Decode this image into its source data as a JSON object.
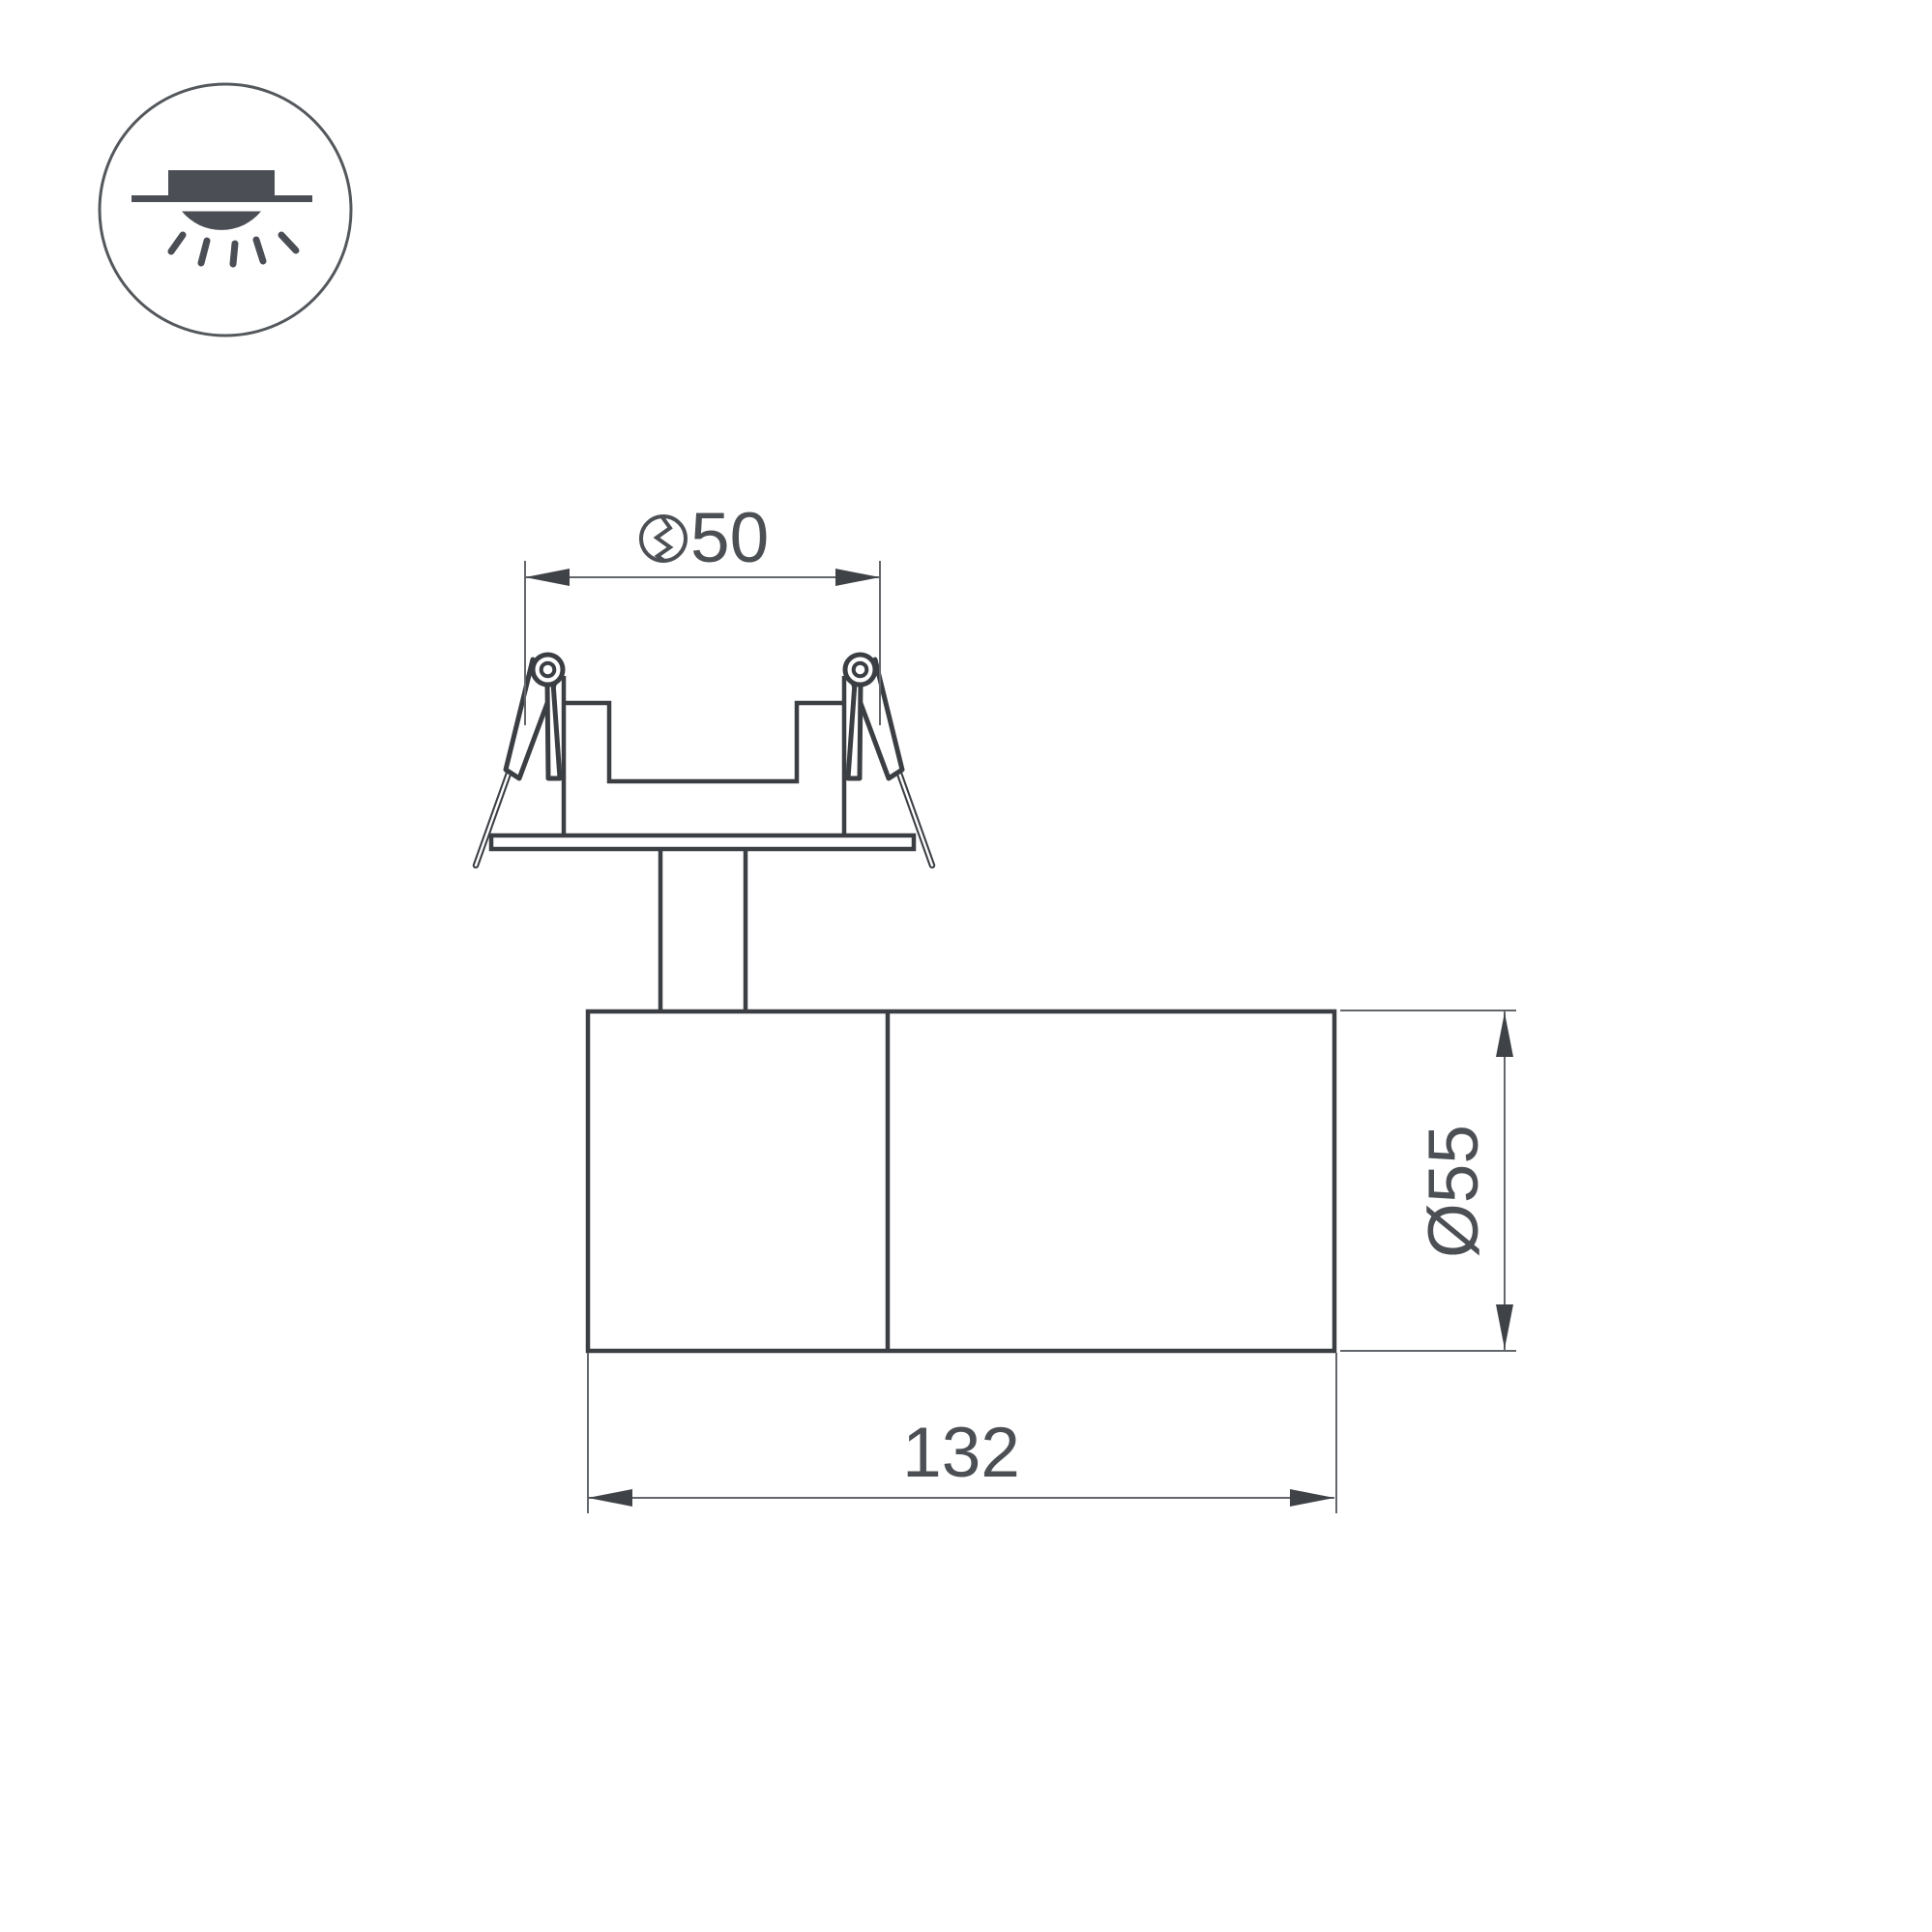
{
  "page": {
    "background": "#ffffff",
    "description": "Technical dimension drawing of a recessed swivel spot luminaire"
  },
  "colors": {
    "outline_bold": "#3B3E43",
    "outline_thin": "#63666B",
    "arrow": "#3F4247",
    "text": "#4C4F54",
    "icon": "#4B4F55",
    "icon_ring": "#54585D"
  },
  "legend_icon": {
    "name": "recessed-downlight-icon"
  },
  "dimensions": {
    "cutout": {
      "value": "50",
      "symbol": "hole-cut-symbol"
    },
    "length": {
      "value": "132"
    },
    "diameter": {
      "value": "Ø55"
    }
  }
}
